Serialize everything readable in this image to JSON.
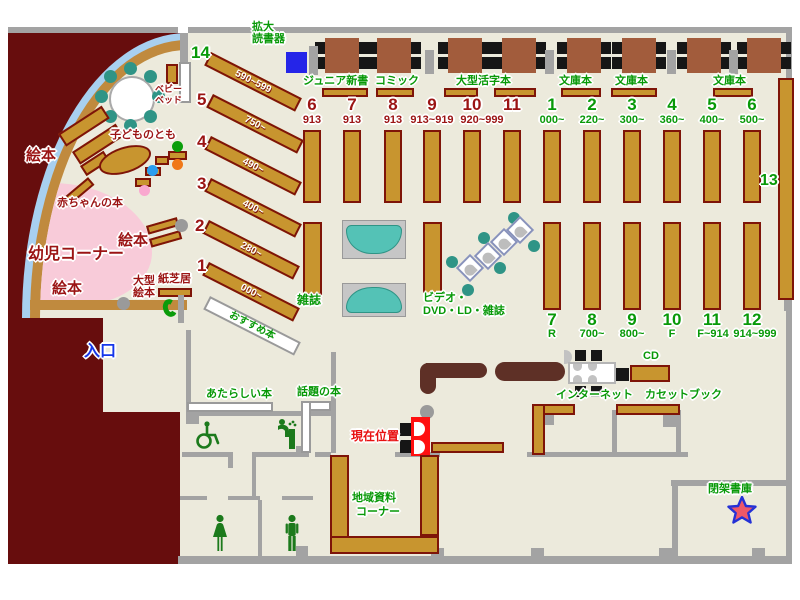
{
  "palette": {
    "beige": "#eceadc",
    "maroon": "#670d0d",
    "shelf": "#c8952f",
    "shelf_border": "#7e1408",
    "wall_gray": "#a3a3a3",
    "green_text": "#089908",
    "dark_red_text": "#9b1414",
    "blue_text": "#1536ea",
    "red_text": "#e81010",
    "pink_area": "#f8cbd9",
    "teal_chair": "#2f9486",
    "table_brown": "#a25c3c",
    "counter_brown": "#5e3026",
    "curve_blue": "#a8d0f0",
    "marker_red": "#ff1010",
    "magnifier_blue": "#2525e8"
  },
  "labels": {
    "kakudai1": "拡大",
    "kakudai2": "読書器",
    "junior": "ジュニア新書",
    "comic": "コミック",
    "ogata_katsuji": "大型活字本",
    "bunko": "文庫本",
    "ehon": "絵本",
    "kodomonotomo": "子どものとも",
    "akachan_hon": "赤ちゃんの本",
    "yoji_corner": "幼児コーナー",
    "ogata1": "大型",
    "ogata2": "絵本",
    "kamishibai": "紙芝居",
    "baby1": "ベビー",
    "baby2": "ベッド",
    "zasshi": "雑誌",
    "video1": "ビデオ・",
    "video2": "DVD・LD・雑誌",
    "osusume": "おすすめ本",
    "iriguchi": "入口",
    "atarashii": "あたらしい本",
    "wadai": "話題の本",
    "genzai": "現在位置",
    "chiiki1": "地域資料",
    "chiiki2": "コーナー",
    "internet": "インターネット",
    "cd": "CD",
    "cassette": "カセットブック",
    "heika": "閉架書庫",
    "thirteen": "13"
  },
  "rows": {
    "top_red": [
      {
        "num": "6",
        "range": "913"
      },
      {
        "num": "7",
        "range": "913"
      },
      {
        "num": "8",
        "range": "913"
      },
      {
        "num": "9",
        "range": "913~919"
      },
      {
        "num": "10",
        "range": "920~999"
      },
      {
        "num": "11",
        "range": ""
      }
    ],
    "top_green": [
      {
        "num": "1",
        "range": "000~"
      },
      {
        "num": "2",
        "range": "220~"
      },
      {
        "num": "3",
        "range": "300~"
      },
      {
        "num": "4",
        "range": "360~"
      },
      {
        "num": "5",
        "range": "400~"
      },
      {
        "num": "6",
        "range": "500~"
      }
    ],
    "bottom_green": [
      {
        "num": "7",
        "range": "R"
      },
      {
        "num": "8",
        "range": "700~"
      },
      {
        "num": "9",
        "range": "800~"
      },
      {
        "num": "10",
        "range": "F"
      },
      {
        "num": "11",
        "range": "F~914"
      },
      {
        "num": "12",
        "range": "914~999"
      }
    ],
    "diagonal": [
      {
        "num": "14",
        "range": "590~599"
      },
      {
        "num": "5",
        "range": "750~"
      },
      {
        "num": "4",
        "range": "490~"
      },
      {
        "num": "3",
        "range": "400~"
      },
      {
        "num": "2",
        "range": "280~"
      },
      {
        "num": "1",
        "range": "000~"
      }
    ]
  }
}
